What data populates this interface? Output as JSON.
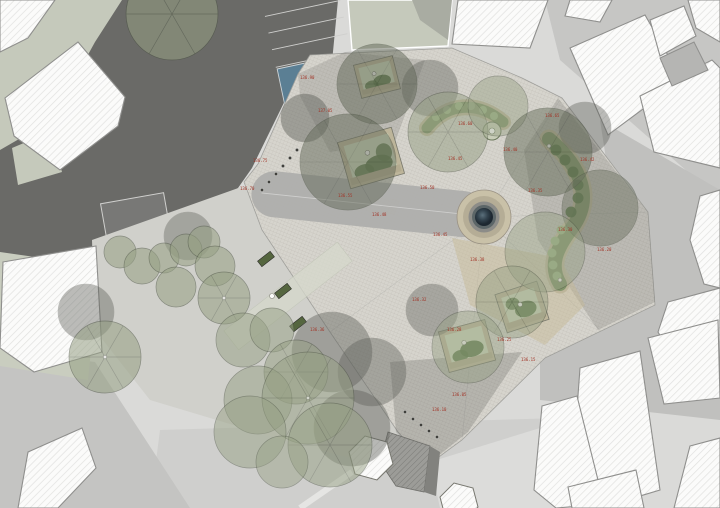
{
  "plan": {
    "kind": "landscape-site-plan",
    "palette": {
      "background": "#dadad8",
      "road_asphalt": "#6a6a67",
      "plaza_paving": "#d6d4cd",
      "lower_plaza": "#d0d0cb",
      "walkway_gray": "#aeaeac",
      "sage_ground": "#c5c9bb",
      "building_white": "#fbfbfa",
      "building_gray": "#b5b5b3",
      "street_gray": "#c6c6c4",
      "canopy_green": "#96a084",
      "canopy_shadow": "#5c5e58",
      "planting_green": "#7f9368",
      "shrub_dark": "#5c7748",
      "bench_tan": "#bdb59a",
      "bench_dark_green": "#55663f",
      "fountain_rim": "#c9c1a8",
      "fountain_water": "#2e3f4a",
      "ochre_paving": "#c6b993",
      "accessible_parking_blue": "#5b7f94",
      "annotation_red": "#a23326",
      "shadow": "#54544f"
    },
    "symbols": {
      "accessible_parking_glyph": "♿"
    }
  },
  "annotations": {
    "spot_levels": [
      {
        "text": "136.90"
      },
      {
        "text": "136.75"
      },
      {
        "text": "136.70"
      },
      {
        "text": "136.55"
      },
      {
        "text": "136.50"
      },
      {
        "text": "136.45"
      },
      {
        "text": "136.60"
      },
      {
        "text": "136.40"
      },
      {
        "text": "136.35"
      },
      {
        "text": "136.30"
      },
      {
        "text": "136.20"
      },
      {
        "text": "136.45"
      },
      {
        "text": "136.38"
      },
      {
        "text": "136.32"
      },
      {
        "text": "136.28"
      },
      {
        "text": "136.25"
      },
      {
        "text": "136.15"
      },
      {
        "text": "136.10"
      },
      {
        "text": "136.48"
      },
      {
        "text": "136.65"
      },
      {
        "text": "136.42"
      },
      {
        "text": "136.36"
      },
      {
        "text": "137.05"
      },
      {
        "text": "136.05"
      }
    ]
  }
}
